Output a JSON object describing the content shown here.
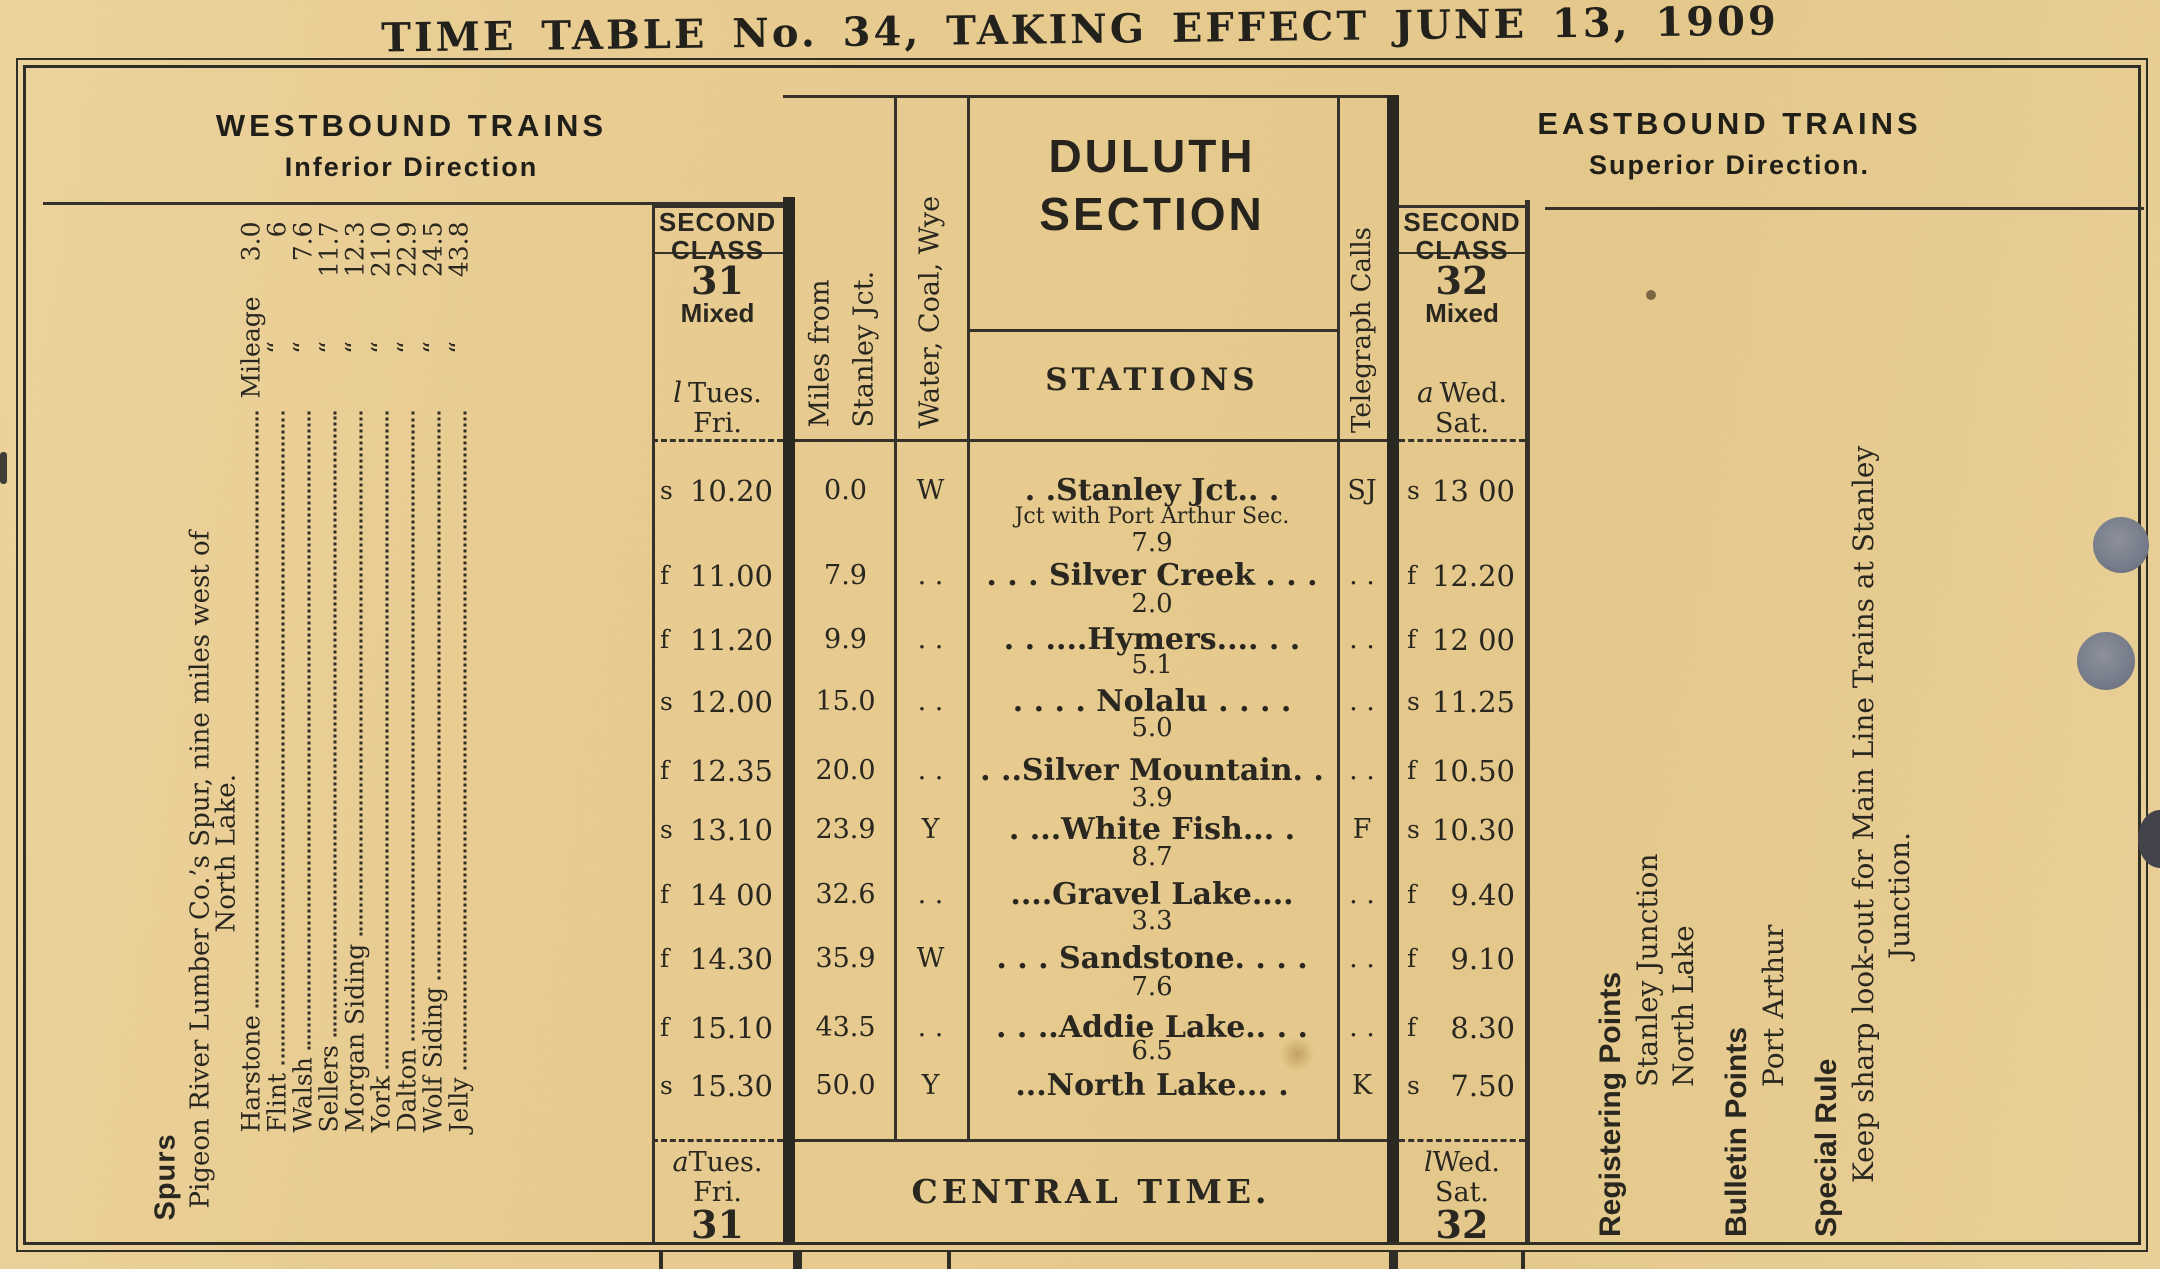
{
  "title": "TIME TABLE No. 34, TAKING EFFECT JUNE 13, 1909",
  "westbound": {
    "heading": "WESTBOUND TRAINS",
    "subheading": "Inferior Direction"
  },
  "eastbound": {
    "heading": "EASTBOUND TRAINS",
    "subheading": "Superior Direction."
  },
  "section": {
    "title_line1": "DULUTH",
    "title_line2": "SECTION",
    "stations_label": "STATIONS",
    "central_time": "CENTRAL TIME."
  },
  "columns": {
    "miles_line1": "Miles from",
    "miles_line2": "Stanley Jct.",
    "water": "Water, Coal, Wye",
    "telegraph": "Telegraph Calls"
  },
  "train31": {
    "class_label": "SECOND CLASS",
    "number": "31",
    "service": "Mixed",
    "head_prefix": "l",
    "head_days1": "Tues.",
    "head_days2": "Fri.",
    "foot_prefix": "a",
    "foot_days1": "Tues.",
    "foot_days2": "Fri.",
    "foot_number": "31"
  },
  "train32": {
    "class_label": "SECOND CLASS",
    "number": "32",
    "service": "Mixed",
    "head_prefix": "a",
    "head_days1": "Wed.",
    "head_days2": "Sat.",
    "foot_prefix": "l",
    "foot_days1": "Wed.",
    "foot_days2": "Sat.",
    "foot_number": "32"
  },
  "spurs": {
    "label": "Spurs",
    "intro1": "Pigeon River Lumber Co.’s Spur, nine miles west of",
    "intro2": "North Lake.",
    "items": [
      {
        "name": "Harstone",
        "label": "Mileage",
        "value": "3.0"
      },
      {
        "name": "Flint",
        "label": "“",
        "value": "6"
      },
      {
        "name": "Walsh",
        "label": "“",
        "value": "7.6"
      },
      {
        "name": "Sellers",
        "label": "“",
        "value": "11.7"
      },
      {
        "name": "Morgan Siding",
        "label": "“",
        "value": "12.3"
      },
      {
        "name": "York",
        "label": "“",
        "value": "21.0"
      },
      {
        "name": "Dalton",
        "label": "“",
        "value": "22.9"
      },
      {
        "name": "Wolf Siding",
        "label": "“",
        "value": "24.5"
      },
      {
        "name": "Jelly",
        "label": "“",
        "value": "43.8"
      }
    ]
  },
  "rows": [
    {
      "t31p": "s",
      "t31": "10.20",
      "miles": "0.0",
      "water": "W",
      "station": ". .Stanley Jct.. .",
      "note": "Jct with Port Arthur Sec.",
      "dist": "7.9",
      "tel": "SJ",
      "t32p": "s",
      "t32": "13 00"
    },
    {
      "t31p": "f",
      "t31": "11.00",
      "miles": "7.9",
      "water": ". .",
      "station": ". . . Silver Creek . . .",
      "dist": "2.0",
      "tel": ". .",
      "t32p": "f",
      "t32": "12.20"
    },
    {
      "t31p": "f",
      "t31": "11.20",
      "miles": "9.9",
      "water": ". .",
      "station": ". . ....Hymers.... . .",
      "dist": "5.1",
      "tel": ". .",
      "t32p": "f",
      "t32": "12 00"
    },
    {
      "t31p": "s",
      "t31": "12.00",
      "miles": "15.0",
      "water": ". .",
      "station": ". . . . Nolalu . . . .",
      "dist": "5.0",
      "tel": ". .",
      "t32p": "s",
      "t32": "11.25"
    },
    {
      "t31p": "f",
      "t31": "12.35",
      "miles": "20.0",
      "water": ". .",
      "station": ". ..Silver Mountain. .",
      "dist": "3.9",
      "tel": ". .",
      "t32p": "f",
      "t32": "10.50"
    },
    {
      "t31p": "s",
      "t31": "13.10",
      "miles": "23.9",
      "water": "Y",
      "station": ". ...White Fish... .",
      "dist": "8.7",
      "tel": "F",
      "t32p": "s",
      "t32": "10.30"
    },
    {
      "t31p": "f",
      "t31": "14 00",
      "miles": "32.6",
      "water": ". .",
      "station": "....Gravel Lake....",
      "dist": "3.3",
      "tel": ". .",
      "t32p": "f",
      "t32": "9.40"
    },
    {
      "t31p": "f",
      "t31": "14.30",
      "miles": "35.9",
      "water": "W",
      "station": ". . . Sandstone. . . .",
      "dist": "7.6",
      "tel": ". .",
      "t32p": "f",
      "t32": "9.10"
    },
    {
      "t31p": "f",
      "t31": "15.10",
      "miles": "43.5",
      "water": ". .",
      "station": ". . ..Addie Lake.. . .",
      "dist": "6.5",
      "tel": ". .",
      "t32p": "f",
      "t32": "8.30"
    },
    {
      "t31p": "s",
      "t31": "15.30",
      "miles": "50.0",
      "water": "Y",
      "station": "...North Lake... .",
      "tel": "K",
      "t32p": "s",
      "t32": "7.50"
    }
  ],
  "east_notes": {
    "registering_label": "Registering Points",
    "registering_1": "Stanley Junction",
    "registering_2": "North Lake",
    "bulletin_label": "Bulletin Points",
    "bulletin_1": "Port Arthur",
    "special_label": "Special Rule",
    "special_1": "Keep sharp look-out for Main Line Trains at Stanley",
    "special_2": "Junction."
  }
}
